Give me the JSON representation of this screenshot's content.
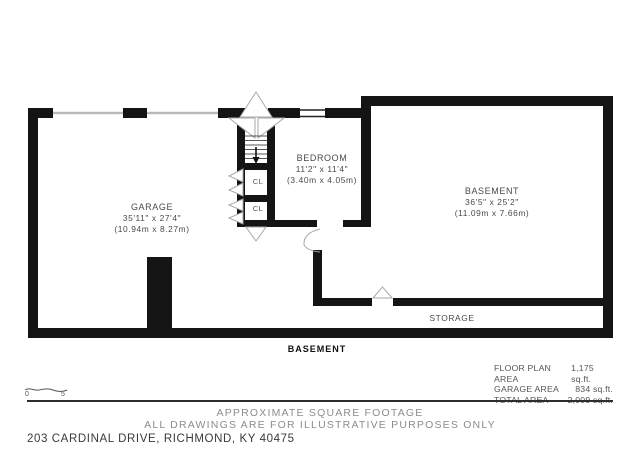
{
  "colors": {
    "wall": "#141414",
    "room_label": "#4a4a4a",
    "muted_text": "#8c8c8c",
    "address_text": "#3a3a3a"
  },
  "rooms": {
    "garage": {
      "name": "GARAGE",
      "imperial": "35'11\" x 27'4\"",
      "metric": "(10.94m x 8.27m)"
    },
    "bedroom": {
      "name": "BEDROOM",
      "imperial": "11'2\" x 11'4\"",
      "metric": "(3.40m x 4.05m)"
    },
    "basement": {
      "name": "BASEMENT",
      "imperial": "36'5\" x 25'2\"",
      "metric": "(11.09m x 7.66m)"
    },
    "storage": {
      "name": "STORAGE"
    },
    "closet1": {
      "name": "CL"
    },
    "closet2": {
      "name": "CL"
    }
  },
  "floor_label": "BASEMENT",
  "areas": {
    "rows": [
      {
        "label": "FLOOR PLAN AREA",
        "value": "1,175 sq.ft."
      },
      {
        "label": "GARAGE AREA",
        "value": "834 sq.ft."
      },
      {
        "label": "TOTAL AREA",
        "value": "2,009 sq.ft."
      }
    ]
  },
  "scale": {
    "start": "0",
    "end": "5"
  },
  "footer": {
    "line1": "APPROXIMATE SQUARE FOOTAGE",
    "line2": "ALL DRAWINGS ARE FOR ILLUSTRATIVE PURPOSES ONLY",
    "address": "203 CARDINAL DRIVE, RICHMOND, KY 40475"
  }
}
